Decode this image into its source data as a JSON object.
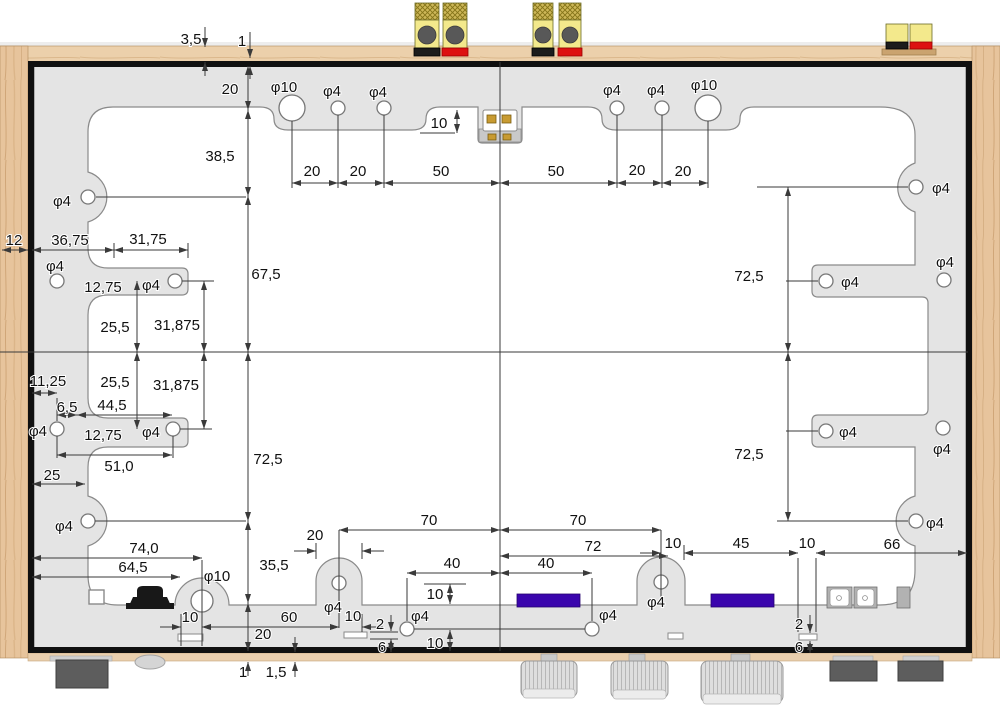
{
  "drawing": {
    "dimension_labels": [
      {
        "t": "3,5",
        "x": 191,
        "y": 44
      },
      {
        "t": "1",
        "x": 242,
        "y": 46
      },
      {
        "t": "20",
        "x": 230,
        "y": 94
      },
      {
        "t": "38,5",
        "x": 220,
        "y": 161
      },
      {
        "t": "67,5",
        "x": 266,
        "y": 279
      },
      {
        "t": "72,5",
        "x": 268,
        "y": 464
      },
      {
        "t": "35,5",
        "x": 274,
        "y": 570
      },
      {
        "t": "20",
        "x": 263,
        "y": 639
      },
      {
        "t": "1",
        "x": 243,
        "y": 677
      },
      {
        "t": "1,5",
        "x": 276,
        "y": 677
      },
      {
        "t": "φ10",
        "x": 284,
        "y": 92
      },
      {
        "t": "φ4",
        "x": 332,
        "y": 96
      },
      {
        "t": "φ4",
        "x": 378,
        "y": 97
      },
      {
        "t": "10",
        "x": 439,
        "y": 128
      },
      {
        "t": "φ4",
        "x": 612,
        "y": 95
      },
      {
        "t": "φ4",
        "x": 656,
        "y": 95
      },
      {
        "t": "φ10",
        "x": 704,
        "y": 90
      },
      {
        "t": "20",
        "x": 312,
        "y": 176
      },
      {
        "t": "20",
        "x": 358,
        "y": 176
      },
      {
        "t": "50",
        "x": 441,
        "y": 176
      },
      {
        "t": "50",
        "x": 556,
        "y": 176
      },
      {
        "t": "20",
        "x": 637,
        "y": 175
      },
      {
        "t": "20",
        "x": 683,
        "y": 176
      },
      {
        "t": "φ4",
        "x": 62,
        "y": 206
      },
      {
        "t": "φ4",
        "x": 941,
        "y": 193
      },
      {
        "t": "12",
        "x": 14,
        "y": 245
      },
      {
        "t": "36,75",
        "x": 70,
        "y": 245
      },
      {
        "t": "31,75",
        "x": 148,
        "y": 244
      },
      {
        "t": "φ4",
        "x": 55,
        "y": 271
      },
      {
        "t": "12,75",
        "x": 103,
        "y": 292
      },
      {
        "t": "φ4",
        "x": 151,
        "y": 290
      },
      {
        "t": "25,5",
        "x": 115,
        "y": 332
      },
      {
        "t": "31,875",
        "x": 177,
        "y": 330
      },
      {
        "t": "25,5",
        "x": 115,
        "y": 387
      },
      {
        "t": "31,875",
        "x": 176,
        "y": 390
      },
      {
        "t": "11,25",
        "x": 48,
        "y": 386
      },
      {
        "t": "6,5",
        "x": 67,
        "y": 412
      },
      {
        "t": "44,5",
        "x": 112,
        "y": 410
      },
      {
        "t": "φ4",
        "x": 38,
        "y": 436
      },
      {
        "t": "12,75",
        "x": 103,
        "y": 440
      },
      {
        "t": "φ4",
        "x": 151,
        "y": 437
      },
      {
        "t": "51,0",
        "x": 119,
        "y": 471
      },
      {
        "t": "25",
        "x": 52,
        "y": 480
      },
      {
        "t": "φ4",
        "x": 64,
        "y": 531
      },
      {
        "t": "72,5",
        "x": 749,
        "y": 281
      },
      {
        "t": "72,5",
        "x": 749,
        "y": 459
      },
      {
        "t": "φ4",
        "x": 850,
        "y": 287
      },
      {
        "t": "φ4",
        "x": 945,
        "y": 267
      },
      {
        "t": "φ4",
        "x": 848,
        "y": 437
      },
      {
        "t": "φ4",
        "x": 942,
        "y": 454
      },
      {
        "t": "φ4",
        "x": 935,
        "y": 528
      },
      {
        "t": "74,0",
        "x": 144,
        "y": 553
      },
      {
        "t": "64,5",
        "x": 133,
        "y": 572
      },
      {
        "t": "φ10",
        "x": 217,
        "y": 581
      },
      {
        "t": "10",
        "x": 190,
        "y": 622
      },
      {
        "t": "60",
        "x": 289,
        "y": 622
      },
      {
        "t": "10",
        "x": 353,
        "y": 621
      },
      {
        "t": "2",
        "x": 380,
        "y": 629
      },
      {
        "t": "6",
        "x": 382,
        "y": 652
      },
      {
        "t": "20",
        "x": 315,
        "y": 540
      },
      {
        "t": "φ4",
        "x": 333,
        "y": 612
      },
      {
        "t": "70",
        "x": 429,
        "y": 525
      },
      {
        "t": "70",
        "x": 578,
        "y": 525
      },
      {
        "t": "72",
        "x": 593,
        "y": 551
      },
      {
        "t": "40",
        "x": 452,
        "y": 568
      },
      {
        "t": "40",
        "x": 546,
        "y": 568
      },
      {
        "t": "10",
        "x": 435,
        "y": 599
      },
      {
        "t": "φ4",
        "x": 420,
        "y": 621
      },
      {
        "t": "10",
        "x": 435,
        "y": 648
      },
      {
        "t": "φ4",
        "x": 608,
        "y": 620
      },
      {
        "t": "φ4",
        "x": 656,
        "y": 607
      },
      {
        "t": "10",
        "x": 673,
        "y": 548
      },
      {
        "t": "45",
        "x": 741,
        "y": 548
      },
      {
        "t": "10",
        "x": 807,
        "y": 548
      },
      {
        "t": "66",
        "x": 892,
        "y": 549
      },
      {
        "t": "2",
        "x": 799,
        "y": 629
      },
      {
        "t": "6",
        "x": 799,
        "y": 652
      }
    ]
  },
  "colors": {
    "panel": "#e4e4e4",
    "cutout": "#ffffff",
    "wood": "#e7c49c",
    "connector_purple": "#3A05AD",
    "terminal_yellow": "#f3e98c",
    "terminal_red": "#dd1111",
    "terminal_black": "#1c1c1c",
    "knob_gray": "#dcdcdc",
    "foot_gray": "#5d5d5d"
  }
}
